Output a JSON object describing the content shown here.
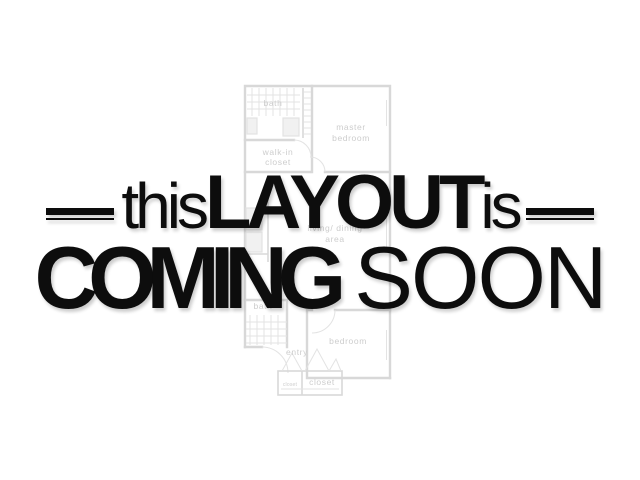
{
  "canvas": {
    "width": 640,
    "height": 480,
    "background": "#ffffff"
  },
  "headline": {
    "word_this": "this",
    "word_layout": "LAYOUT",
    "word_is": "is",
    "word_coming": "COMING",
    "word_soon": "SOON",
    "text_color": "#0d0d0d"
  },
  "decorations": {
    "left_rule": "double-horizontal-rule",
    "right_rule": "double-horizontal-rule"
  },
  "floor_plan": {
    "line_color": "#d8d8d8",
    "thin_line_color": "#e3e3e3",
    "label_color": "#cdcdcd",
    "labels": {
      "bath_upper": "bath",
      "master_line1": "master",
      "master_line2": "bedroom",
      "walkin_line1": "walk-in",
      "walkin_line2": "closet",
      "living_line1": "living/ dining",
      "living_line2": "area",
      "bath_lower": "bath",
      "entry": "entry",
      "bedroom": "bedroom",
      "closet_small": "closet",
      "closet_large": "closet"
    }
  }
}
